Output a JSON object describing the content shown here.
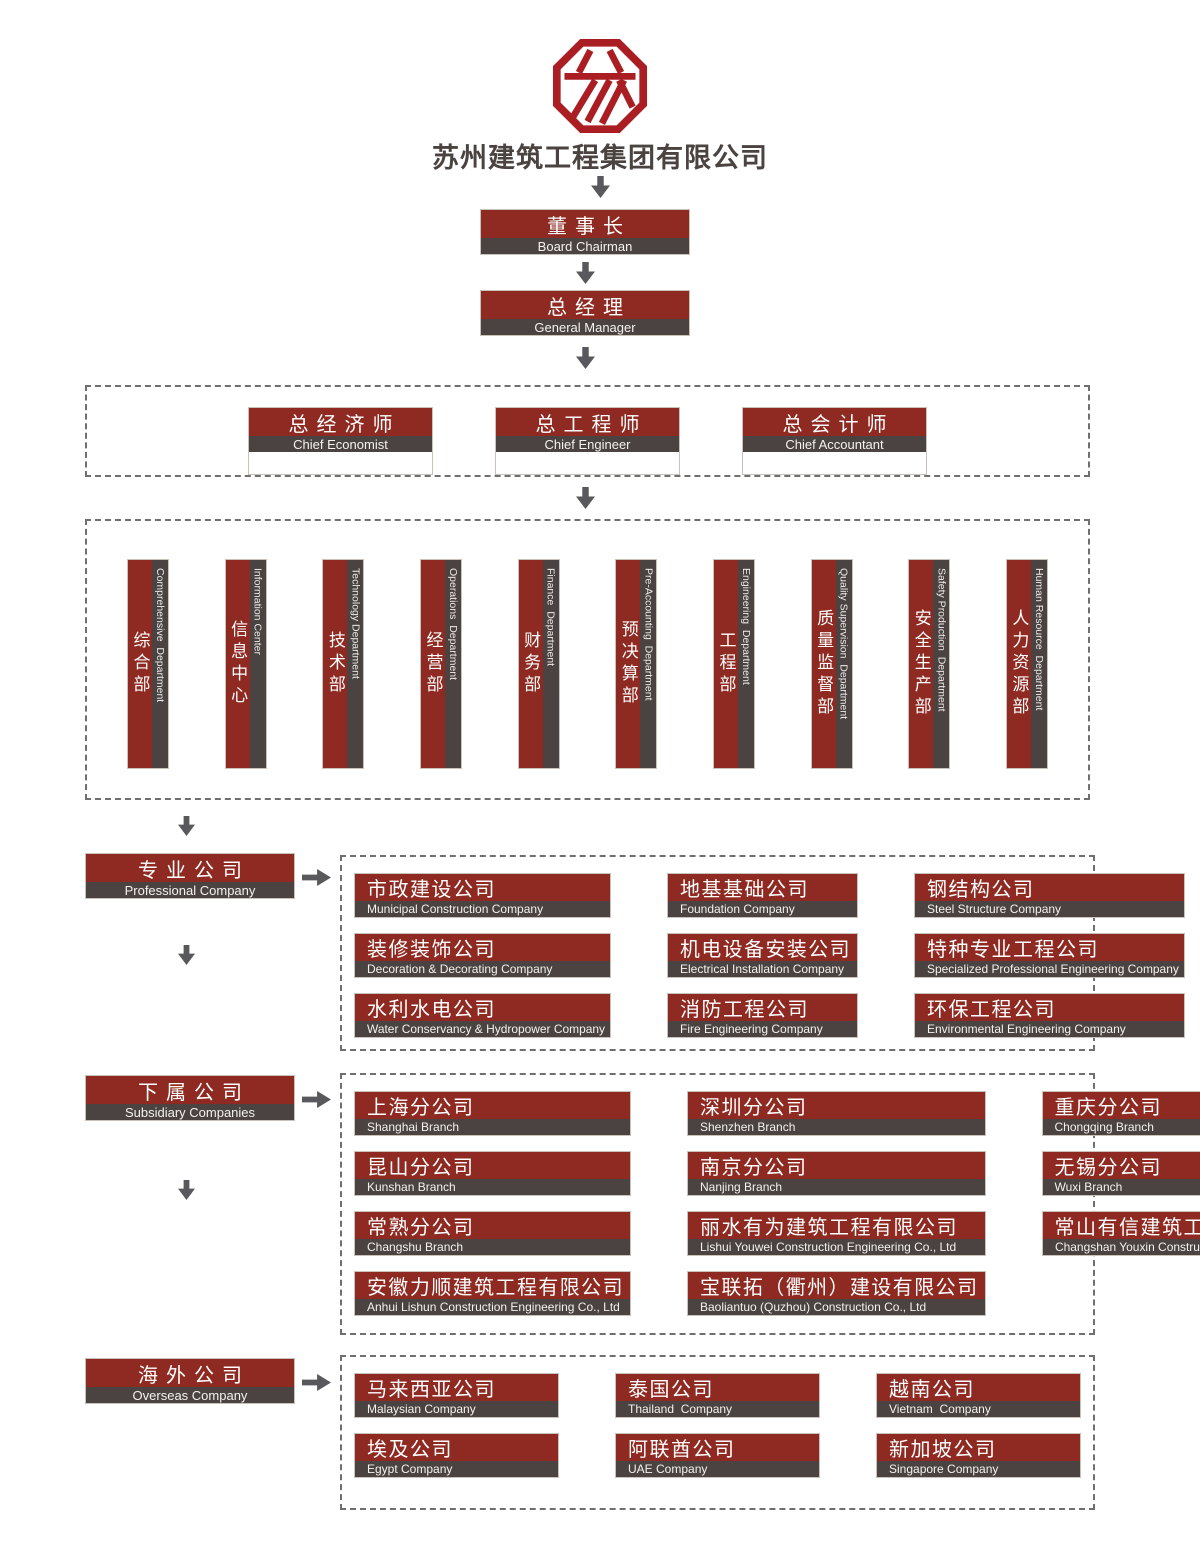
{
  "header": {
    "company_name": "苏州建筑工程集团有限公司"
  },
  "colors": {
    "box_red": "#8e2a21",
    "strip_gray": "#4a4341",
    "logo_red": "#aa1e23",
    "arrow_gray": "#59585c"
  },
  "top_chain": [
    {
      "zh": "董事长",
      "en": "Board Chairman"
    },
    {
      "zh": "总经理",
      "en": "General Manager"
    }
  ],
  "chiefs": [
    {
      "zh": "总经济师",
      "en": "Chief Economist"
    },
    {
      "zh": "总工程师",
      "en": "Chief Engineer"
    },
    {
      "zh": "总会计师",
      "en": "Chief Accountant"
    }
  ],
  "departments": [
    {
      "zh": "综合部",
      "en": "Comprehensive  Department"
    },
    {
      "zh": "信息中心",
      "en": "Information Center"
    },
    {
      "zh": "技术部",
      "en": "Technology Department"
    },
    {
      "zh": "经营部",
      "en": "Operations  Department"
    },
    {
      "zh": "财务部",
      "en": "Finance  Department"
    },
    {
      "zh": "预决算部",
      "en": "Pre-Accounting  Department"
    },
    {
      "zh": "工程部",
      "en": "Engineering  Department"
    },
    {
      "zh": "质量监督部",
      "en": "Quality Supervision  Department"
    },
    {
      "zh": "安全生产部",
      "en": "Safety Production  Department"
    },
    {
      "zh": "人力资源部",
      "en": "Human Resource  Department"
    }
  ],
  "groups": [
    {
      "label": {
        "zh": "专业公司",
        "en": "Professional Company"
      },
      "items": [
        {
          "zh": "市政建设公司",
          "en": "Municipal Construction Company"
        },
        {
          "zh": "地基基础公司",
          "en": "Foundation Company"
        },
        {
          "zh": "钢结构公司",
          "en": "Steel Structure Company"
        },
        {
          "zh": "装修装饰公司",
          "en": "Decoration & Decorating Company"
        },
        {
          "zh": "机电设备安装公司",
          "en": "Electrical Installation Company"
        },
        {
          "zh": "特种专业工程公司",
          "en": "Specialized Professional Engineering Company"
        },
        {
          "zh": "水利水电公司",
          "en": "Water Conservancy & Hydropower Company"
        },
        {
          "zh": "消防工程公司",
          "en": "Fire Engineering Company"
        },
        {
          "zh": "环保工程公司",
          "en": "Environmental Engineering Company"
        }
      ]
    },
    {
      "label": {
        "zh": "下属公司",
        "en": "Subsidiary Companies"
      },
      "items": [
        {
          "zh": "上海分公司",
          "en": "Shanghai Branch"
        },
        {
          "zh": "深圳分公司",
          "en": "Shenzhen Branch"
        },
        {
          "zh": "重庆分公司",
          "en": "Chongqing Branch"
        },
        {
          "zh": "昆山分公司",
          "en": "Kunshan Branch"
        },
        {
          "zh": "南京分公司",
          "en": "Nanjing Branch"
        },
        {
          "zh": "无锡分公司",
          "en": "Wuxi Branch"
        },
        {
          "zh": "常熟分公司",
          "en": "Changshu Branch"
        },
        {
          "zh": "丽水有为建筑工程有限公司",
          "en": "Lishui Youwei Construction Engineering Co., Ltd"
        },
        {
          "zh": "常山有信建筑工程有限公司",
          "en": "Changshan Youxin Construction Engineering Co., Ltd"
        },
        {
          "zh": "安徽力顺建筑工程有限公司",
          "en": "Anhui Lishun Construction Engineering Co., Ltd"
        },
        {
          "zh": "宝联拓（衢州）建设有限公司",
          "en": "Baoliantuo (Quzhou) Construction Co., Ltd"
        }
      ]
    },
    {
      "label": {
        "zh": "海外公司",
        "en": "Overseas Company"
      },
      "items": [
        {
          "zh": "马来西亚公司",
          "en": "Malaysian Company"
        },
        {
          "zh": "泰国公司",
          "en": "Thailand  Company"
        },
        {
          "zh": "越南公司",
          "en": "Vietnam  Company"
        },
        {
          "zh": "埃及公司",
          "en": "Egypt Company"
        },
        {
          "zh": "阿联酋公司",
          "en": "UAE Company"
        },
        {
          "zh": "新加坡公司",
          "en": "Singapore Company"
        }
      ]
    }
  ]
}
